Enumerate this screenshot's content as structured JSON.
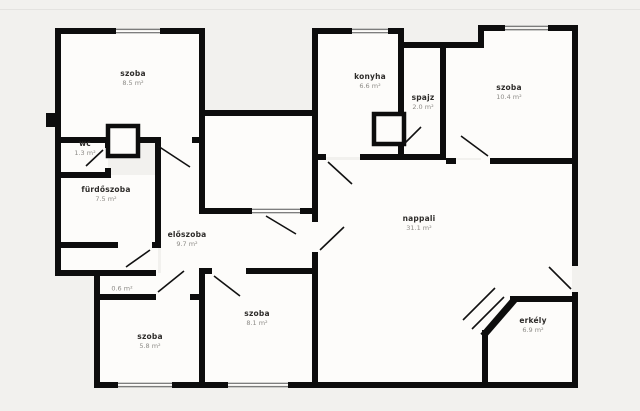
{
  "plan": {
    "type": "apartment-floor-plan",
    "language": "hungarian"
  },
  "colors": {
    "wall": "#0d0d0d",
    "exterior_background": "#f2f1ee",
    "room_fill": "#fdfcfa",
    "room_name_text": "#2e2c2a",
    "room_area_text": "#8d8b87",
    "window_line": "#555555"
  },
  "rooms": [
    {
      "name": "szoba",
      "area": "8.5 m²"
    },
    {
      "name": "wc",
      "area": "1.3 m²"
    },
    {
      "name": "fürdőszoba",
      "area": "7.5 m²"
    },
    {
      "name": "előszoba",
      "area": "9.7 m²"
    },
    {
      "name": "szoba",
      "area": "5.8 m²"
    },
    {
      "name": "",
      "area": "0.6 m²"
    },
    {
      "name": "szoba",
      "area": "8.1 m²"
    },
    {
      "name": "konyha",
      "area": "6.6 m²"
    },
    {
      "name": "spajz",
      "area": "2.0 m²"
    },
    {
      "name": "szoba",
      "area": "10.4 m²"
    },
    {
      "name": "nappali",
      "area": "31.1 m²"
    },
    {
      "name": "erkély",
      "area": "6.9 m²"
    }
  ]
}
